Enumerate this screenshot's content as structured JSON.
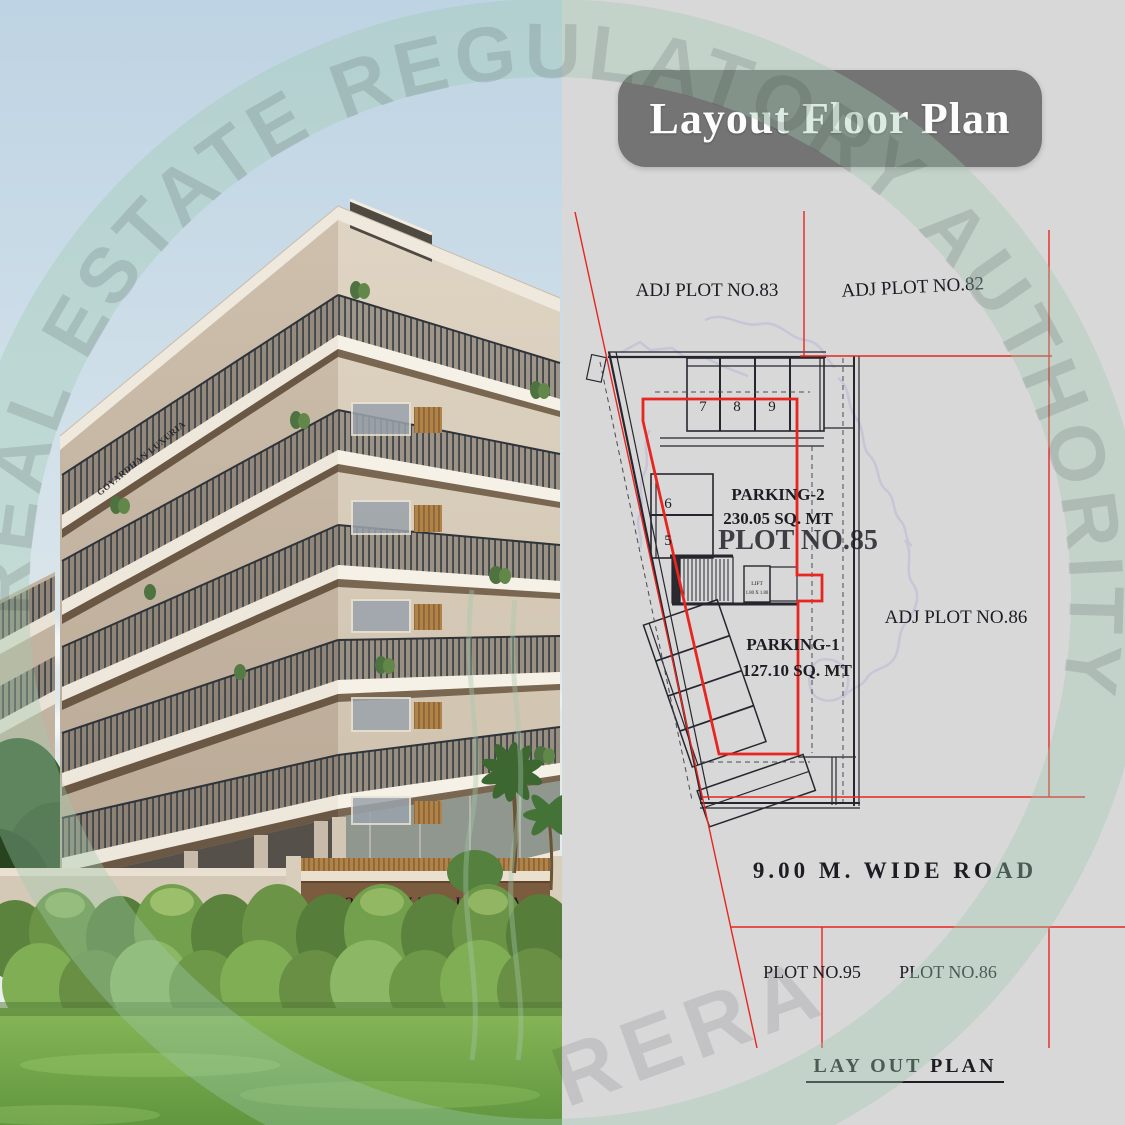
{
  "title": "Layout Floor Plan",
  "watermark": {
    "ring_text": "REAL ESTATE REGULATORY AUTHORITY",
    "stamp": "RERA"
  },
  "photo": {
    "gate_sign": "GOVARDHAN LUXURIA",
    "parapet_sign": "GOVARDHAN LUXURIA"
  },
  "plan": {
    "adj_plot_top_left": "ADJ PLOT NO.83",
    "adj_plot_top_right": "ADJ PLOT NO.82",
    "adj_plot_right": "ADJ PLOT NO.86",
    "plot_label": "PLOT NO.85",
    "parking2_label": "PARKING-2",
    "parking2_area": "230.05 SQ. MT",
    "parking1_label": "PARKING-1",
    "parking1_area": "127.10 SQ. MT",
    "road_label": "9.00 M. WIDE ROAD",
    "plot_bottom_left": "PLOT NO.95",
    "plot_bottom_right": "PLOT NO.86",
    "footer_label": "LAY OUT PLAN",
    "lift_label": "LIFT",
    "lift_size": "1.80 X 1.80",
    "stalls": [
      "7",
      "8",
      "9",
      "6",
      "5"
    ]
  },
  "colors": {
    "accent_red": "#e8251f",
    "plan_line": "#1c1c23",
    "title_bg": "#747474",
    "panel_bg": "#d8d8d9",
    "watermark_green": "#9fcbb0",
    "map_outline": "#b4b4d6"
  }
}
